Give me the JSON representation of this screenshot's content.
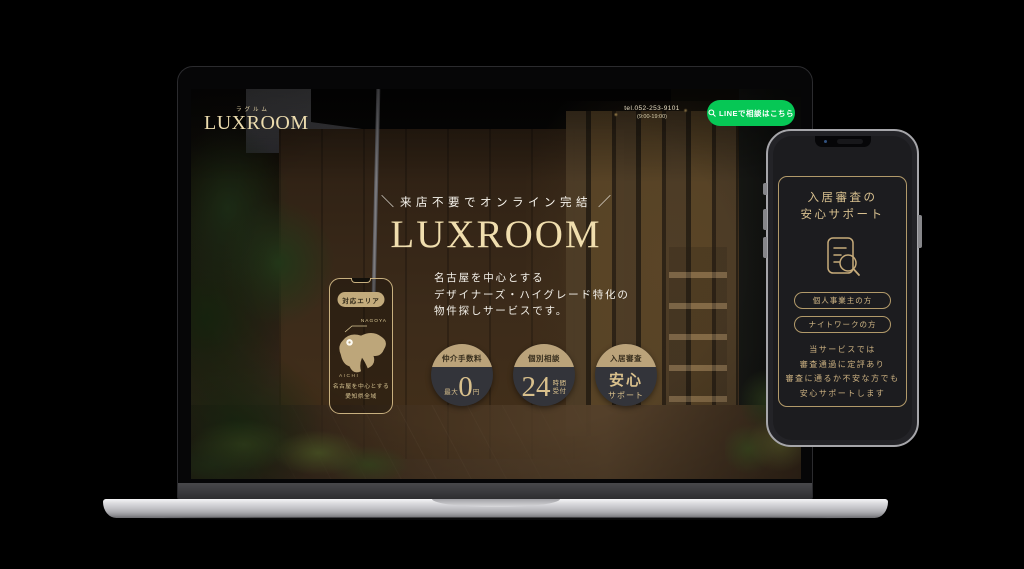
{
  "site": {
    "header": {
      "logo_kana": "ラグルム",
      "logo_text": "LUXROOM",
      "tel": "tel.052-253-9101",
      "hours": "(9:00-19:00)",
      "line_button": "LINEで相談はこちら"
    },
    "hero": {
      "catch_prefix": "＼",
      "catch": "来店不要でオンライン完結",
      "catch_suffix": "／",
      "title": "LUXROOM",
      "desc_lines": [
        "名古屋を中心とする",
        "デザイナーズ・ハイグレード特化の",
        "物件探しサービスです。"
      ]
    },
    "area_phone": {
      "badge": "対応エリア",
      "city_label": "NAGOYA",
      "pref_label": "AICHI",
      "caption_lines": [
        "名古屋を中心とする",
        "愛知県全域"
      ]
    },
    "features": [
      {
        "cap": "仲介手数料",
        "pre": "最大",
        "big": "0",
        "post": "円"
      },
      {
        "cap": "個別相談",
        "big": "24",
        "stack": [
          "時間",
          "受付"
        ]
      },
      {
        "cap": "入居審査",
        "main": "安心",
        "sub": "サポート"
      }
    ]
  },
  "phone_app": {
    "title_lines": [
      "入居審査の",
      "安心サポート"
    ],
    "buttons": [
      "個人事業主の方",
      "ナイトワークの方"
    ],
    "note_lines": [
      "当サービスでは",
      "審査通過に定評あり",
      "審査に通るか不安な方でも",
      "安心サポートします"
    ]
  },
  "colors": {
    "line_green": "#06c755",
    "gold": "#c9b183",
    "cream": "#f0deae",
    "circle_body": "#33343a",
    "circle_cap": "#bba37a"
  }
}
